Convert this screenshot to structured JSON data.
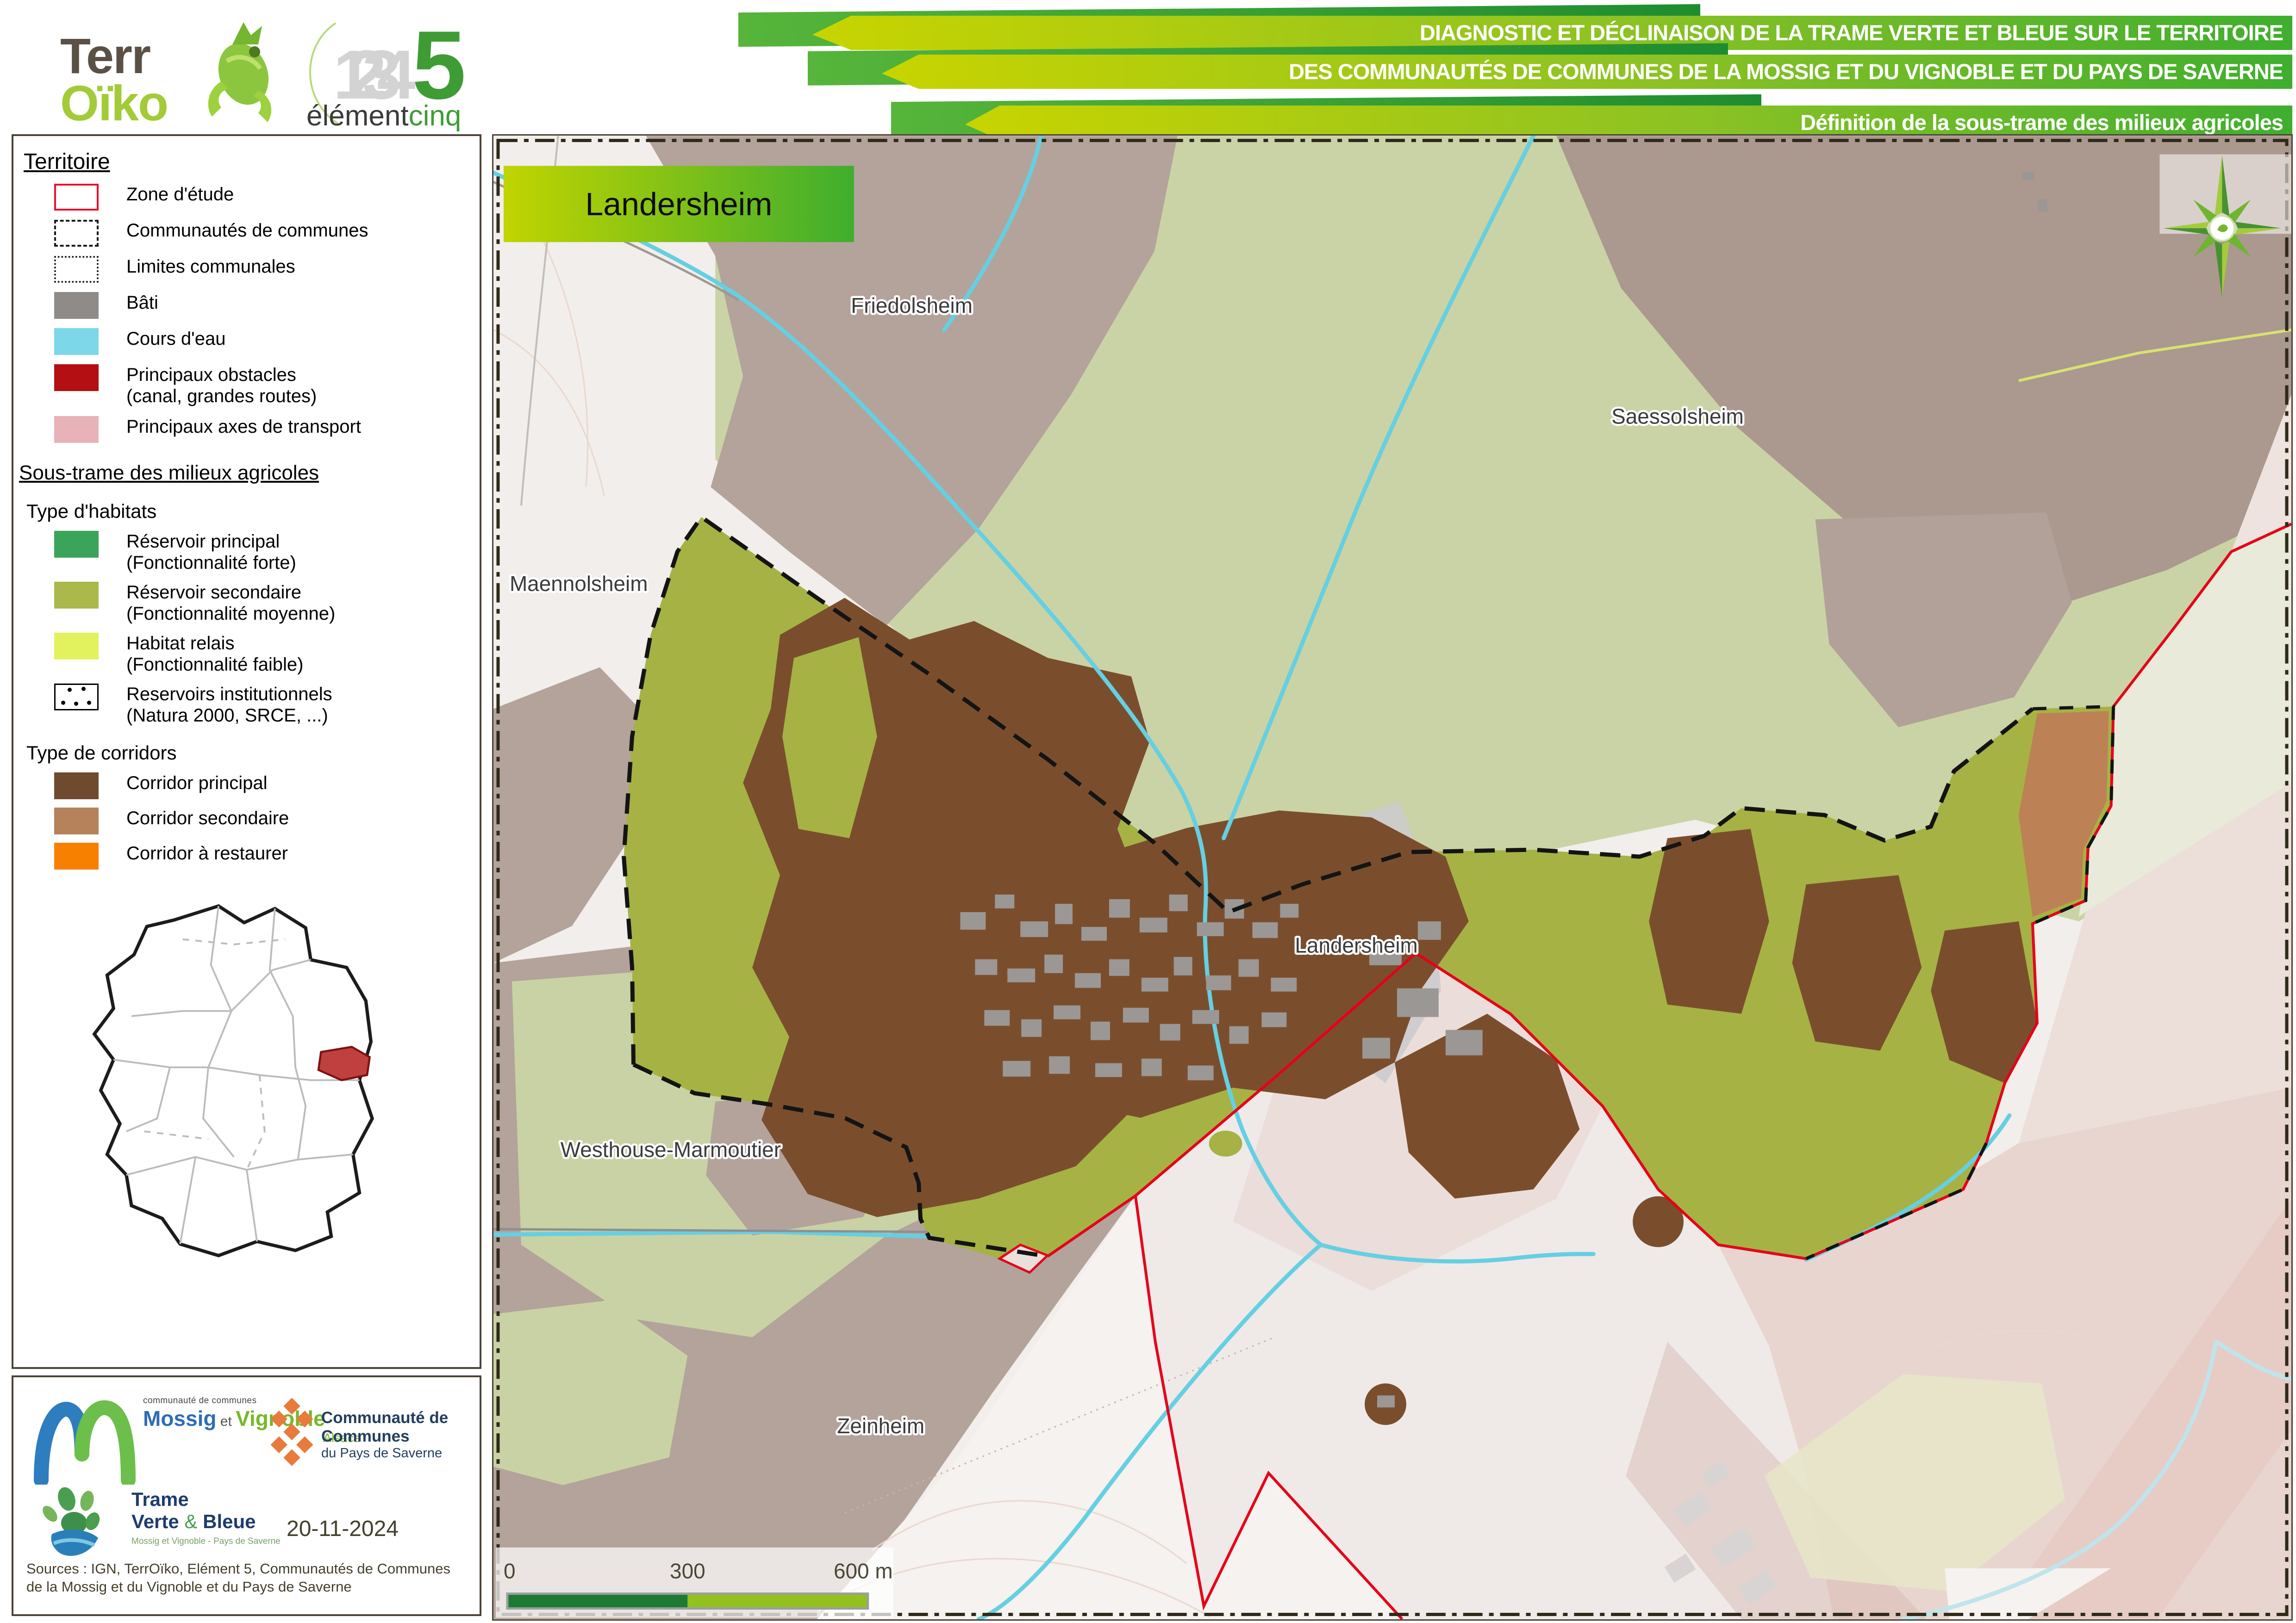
{
  "header": {
    "terroiko": {
      "line1": "Terr",
      "line2": "Oïko"
    },
    "element5": {
      "digits": "1234",
      "five": "5",
      "word1": "élément",
      "word2": "cinq"
    },
    "title_lines": [
      "DIAGNOSTIC ET DÉCLINAISON DE LA TRAME VERTE ET BLEUE SUR LE TERRITOIRE",
      "DES COMMUNAUTÉS DE COMMUNES DE LA MOSSIG ET DU VIGNOBLE ET DU PAYS DE SAVERNE",
      "Définition de la sous-trame des milieux agricoles"
    ]
  },
  "legend": {
    "territoire": {
      "heading": "Territoire",
      "items": [
        {
          "label": "Zone d'étude",
          "swatch": "zone",
          "color": "#e8112d"
        },
        {
          "label": "Communautés de communes",
          "swatch": "dashed",
          "color": "#1a1a1a"
        },
        {
          "label": "Limites communales",
          "swatch": "dotted",
          "color": "#1a1a1a"
        },
        {
          "label": "Bâti",
          "swatch": "fill",
          "color": "#8f8b88"
        },
        {
          "label": "Cours d'eau",
          "swatch": "fill",
          "color": "#7cd7e8"
        },
        {
          "label": "Principaux obstacles",
          "label2": "(canal, grandes routes)",
          "swatch": "fill",
          "color": "#b40f12"
        },
        {
          "label": "Principaux axes de transport",
          "swatch": "fill",
          "color": "#e7b3b8"
        }
      ]
    },
    "soustrame": {
      "heading": "Sous-trame des milieux agricoles",
      "habitats": {
        "subheading": "Type d'habitats",
        "items": [
          {
            "label": "Réservoir principal",
            "label2": "(Fonctionnalité forte)",
            "color": "#3aa45a"
          },
          {
            "label": "Réservoir secondaire",
            "label2": "(Fonctionnalité moyenne)",
            "color": "#abb84b"
          },
          {
            "label": "Habitat relais",
            "label2": "(Fonctionnalité faible)",
            "color": "#e2f25e"
          },
          {
            "label": "Reservoirs institutionnels",
            "label2": "(Natura 2000, SRCE, ...)",
            "swatch": "dots"
          }
        ]
      },
      "corridors": {
        "subheading": "Type de corridors",
        "items": [
          {
            "label": "Corridor principal",
            "color": "#6f4a2f"
          },
          {
            "label": "Corridor secondaire",
            "color": "#b5825c"
          },
          {
            "label": "Corridor à restaurer",
            "color": "#f88000"
          }
        ]
      }
    }
  },
  "map": {
    "title": "Landersheim",
    "labels": {
      "friedolsheim": "Friedolsheim",
      "saessolsheim": "Saessolsheim",
      "maennolsheim": "Maennolsheim",
      "landersheim": "Landersheim",
      "westhouse": "Westhouse-Marmoutier",
      "zeinheim": "Zeinheim"
    },
    "scalebar": {
      "tick0": "0",
      "tick300": "300",
      "tick600": "600 m"
    }
  },
  "footer": {
    "mossig": {
      "top": "communauté de communes",
      "name1": "Mossig",
      "et": " et ",
      "name2": "Vignoble",
      "region": "Alsace"
    },
    "saverne": {
      "line1": "Communauté de Communes",
      "line2": "du Pays de Saverne"
    },
    "tvb": {
      "line1": "Trame",
      "line2_a": "Verte ",
      "amp": "&",
      "line2_b": " Bleue",
      "tagline": "Mossig et Vignoble - Pays de Saverne"
    },
    "date": "20-11-2024",
    "sources": "Sources : IGN, TerrOïko, Elément 5, Communautés de Communes de la Mossig et du Vignoble et du Pays de Saverne"
  },
  "colors": {
    "reservoir_secondaire_zone": "#a6b244",
    "reservoir_secondaire_hors_zone": "#cad3a5",
    "corridor_principal": "#7a4e2d",
    "corridor_secondaire": "#bc8155",
    "transport_mauve": "#b3a39b",
    "cours_eau": "#66cfe2",
    "bati": "#9b9794",
    "zone_etude_rouge": "#e50019",
    "titre_degrade_gauche": "#c1d400",
    "titre_degrade_droite": "#3fae2e"
  }
}
